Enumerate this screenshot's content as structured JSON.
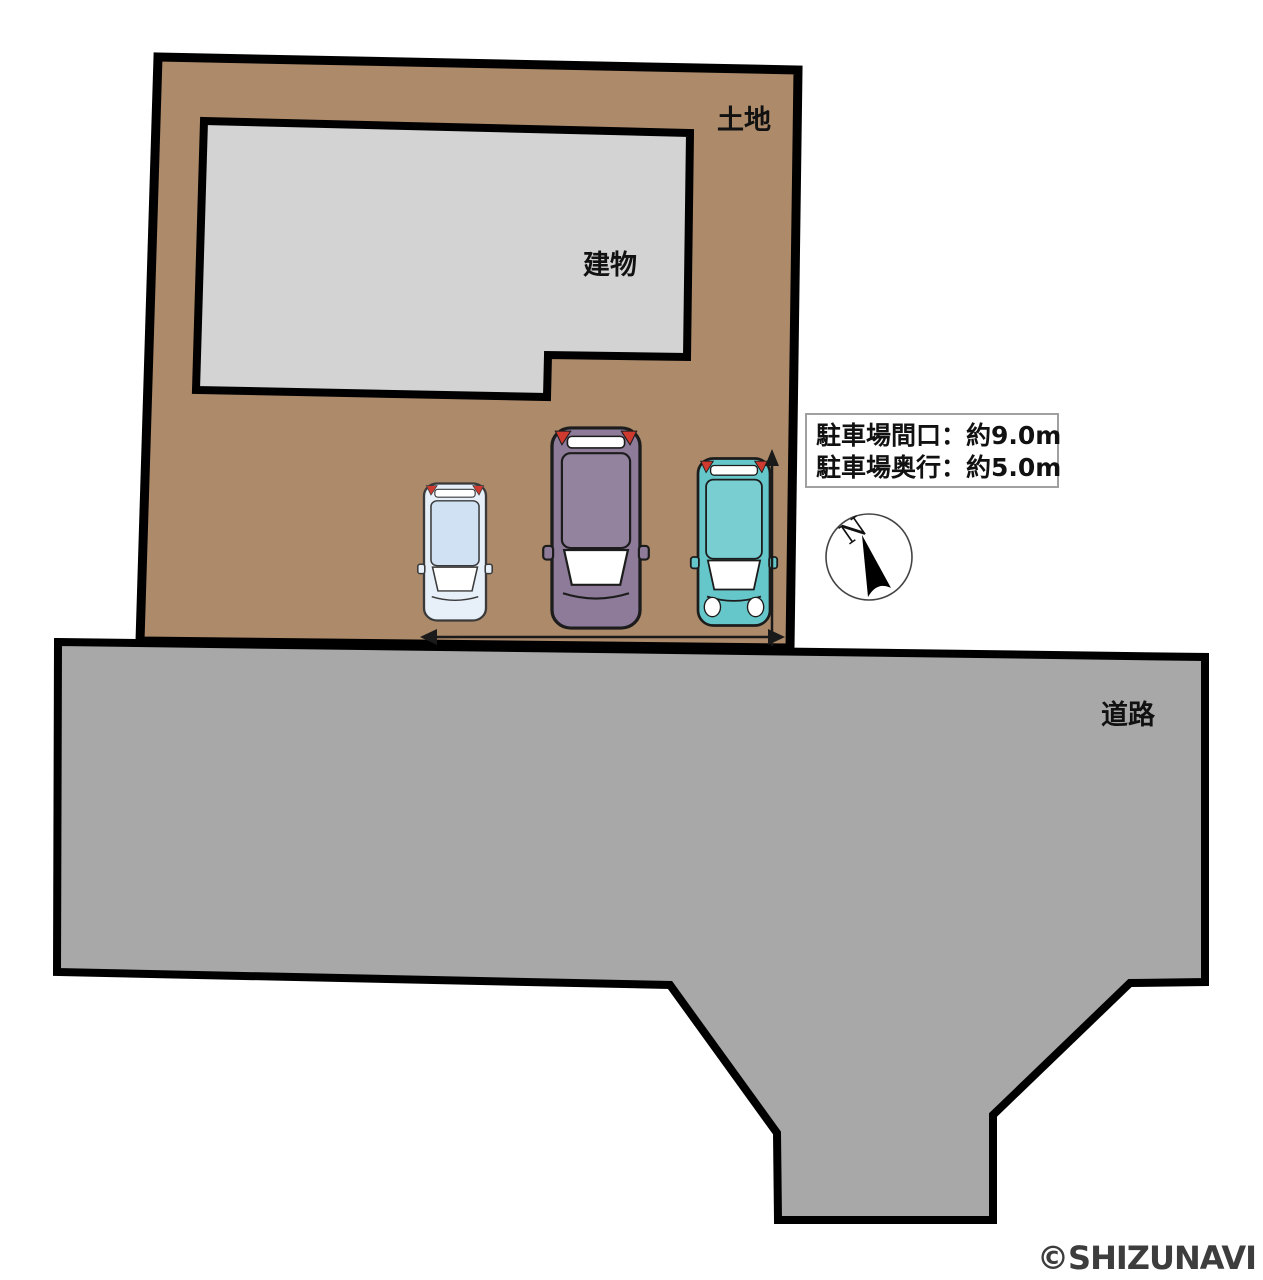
{
  "diagram": {
    "land_label": "土地",
    "building_label": "建物",
    "road_label": "道路"
  },
  "parking_info": {
    "line1": "駐車場間口：約9.0m",
    "line2": "駐車場奥行：約5.0m",
    "frontage_m": "9.0",
    "depth_m": "5.0"
  },
  "compass": {
    "north_label": "N"
  },
  "watermark": "©SHIZUNAVI",
  "colors": {
    "land": "#ac8a6a",
    "building": "#d3d3d3",
    "road": "#a8a8a8",
    "window": "#ffffff",
    "taillight": "#cf3a30",
    "watermark": "#3d3d3d",
    "cars": {
      "kei_body": "#e7eff9",
      "kei_roof": "#cfe1f3",
      "van_body": "#8d7b99",
      "van_roof": "#94839f",
      "hatch_body": "#66c7ca",
      "hatch_roof": "#79ced1"
    }
  }
}
